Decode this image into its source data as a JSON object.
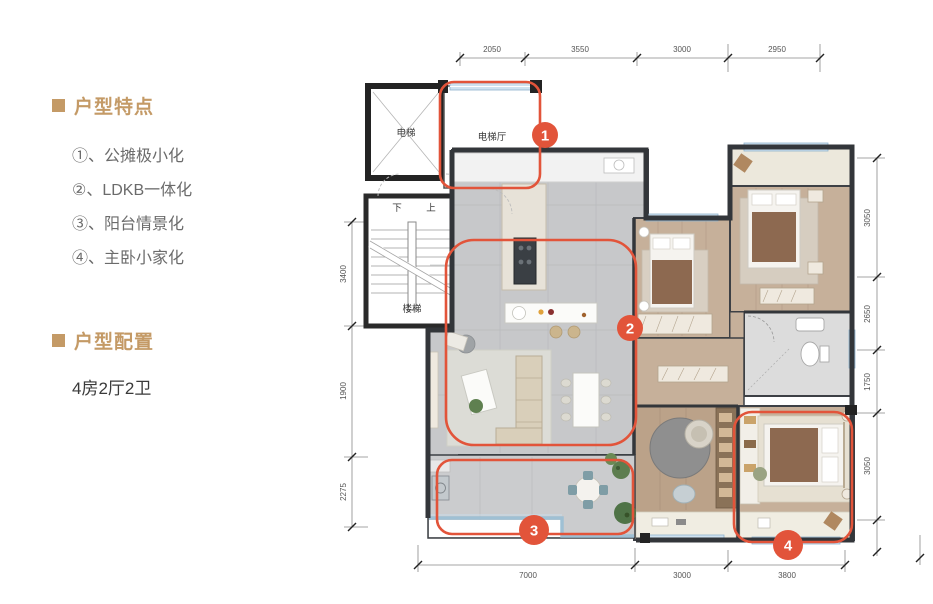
{
  "panel": {
    "features_title": "户型特点",
    "features": [
      "①、公摊极小化",
      "②、LDKB一体化",
      "③、阳台情景化",
      "④、主卧小家化"
    ],
    "config_title": "户型配置",
    "config_value": "4房2厅2卫"
  },
  "plan": {
    "rooms": {
      "elevator": "电梯",
      "elevator_hall": "电梯厅",
      "shaft": "电井",
      "stairs": "楼梯",
      "down": "下",
      "up": "上"
    },
    "highlights": [
      "1",
      "2",
      "3",
      "4"
    ],
    "dimensions": {
      "top": [
        "2050",
        "3550",
        "3000",
        "2950"
      ],
      "bottom": [
        "7000",
        "3000",
        "3800"
      ],
      "left": [
        "3400",
        "1900",
        "2275"
      ],
      "right": [
        "3050",
        "2650",
        "1750",
        "3050"
      ]
    }
  },
  "colors": {
    "accent_red": "#e2543a",
    "gold": "#c49a66",
    "wall": "#3d4045",
    "window_blue": "#bdd7e9"
  }
}
